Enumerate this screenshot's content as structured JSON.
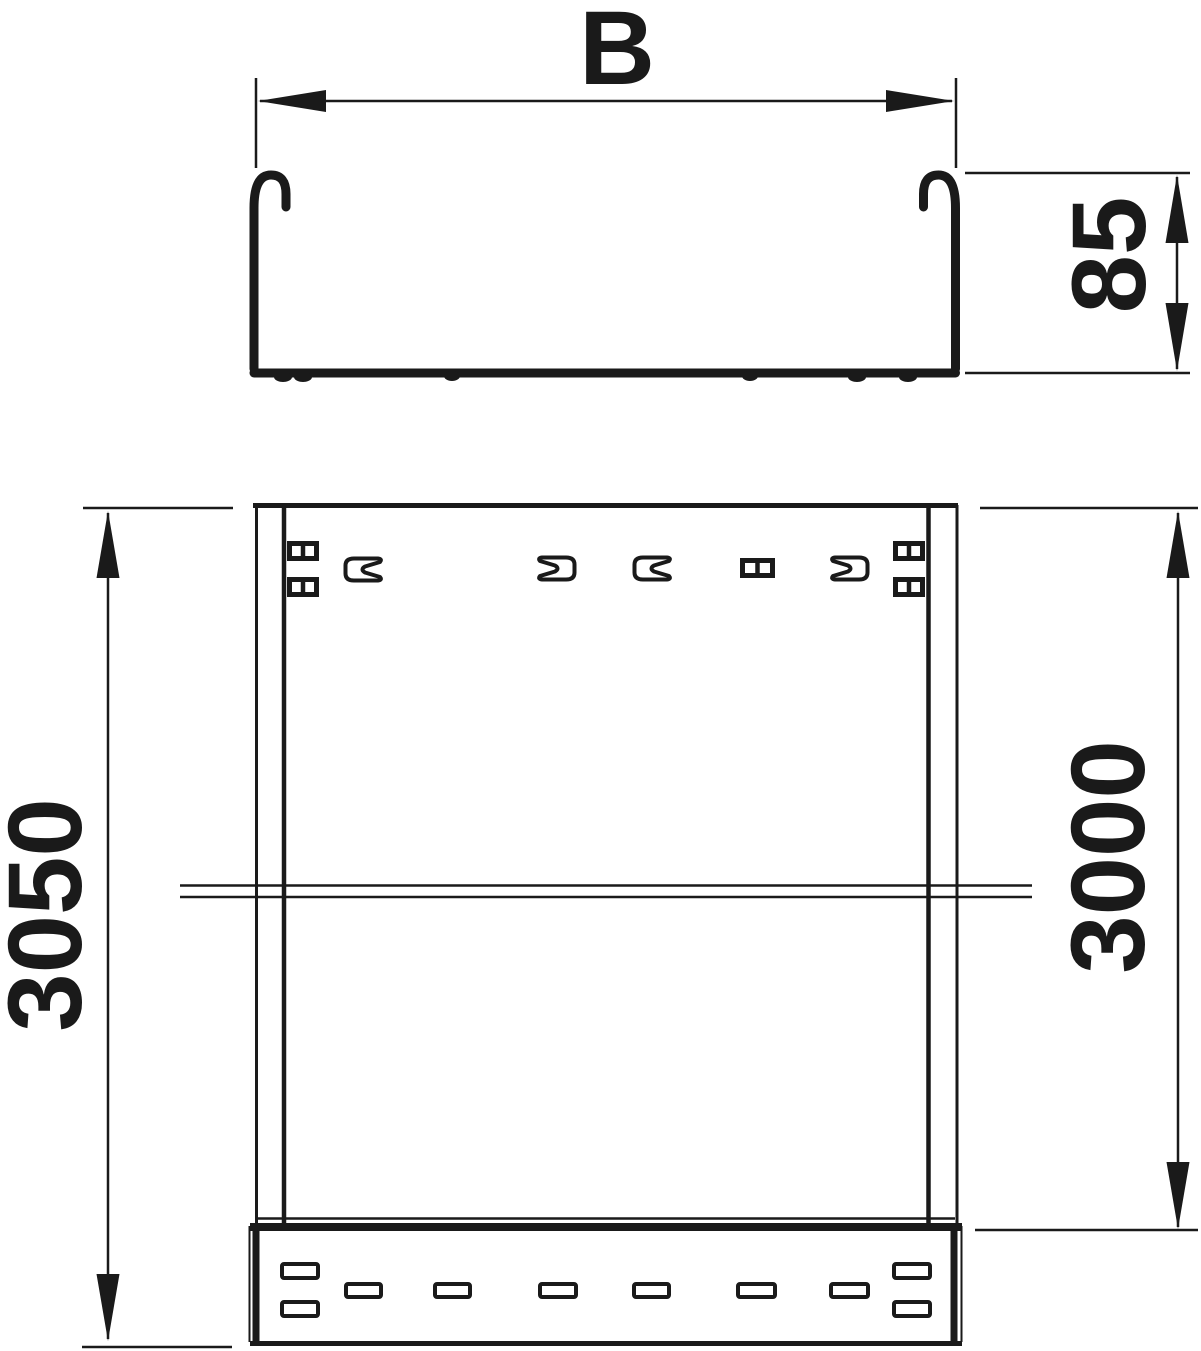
{
  "drawing": {
    "kind": "cable-tray dimensional drawing",
    "colors": {
      "line": "#1a1a1a",
      "background": "#ffffff"
    },
    "dimensions": {
      "width": {
        "label": "B"
      },
      "height": {
        "label": "85"
      },
      "total_length": {
        "label": "3050"
      },
      "segment_length": {
        "label": "3000"
      }
    }
  }
}
